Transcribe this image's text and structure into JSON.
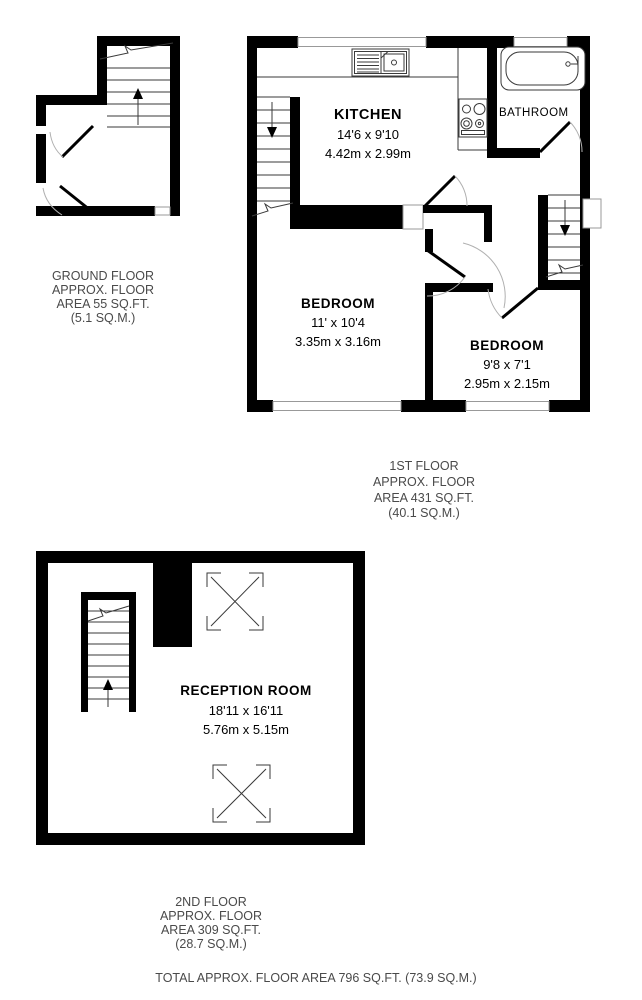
{
  "colors": {
    "wall": "#000000",
    "thin_line": "#3a3a3a",
    "arc": "#b0b0b0",
    "label_text": "#4a4a4a"
  },
  "floors": {
    "ground": {
      "label_lines": [
        "GROUND FLOOR",
        "APPROX. FLOOR",
        "AREA 55 SQ.FT.",
        "(5.1 SQ.M.)"
      ]
    },
    "first": {
      "label_lines": [
        "1ST FLOOR",
        "APPROX. FLOOR",
        "AREA 431 SQ.FT.",
        "(40.1 SQ.M.)"
      ],
      "rooms": {
        "kitchen": {
          "name": "KITCHEN",
          "dims_ft": "14'6 x 9'10",
          "dims_m": "4.42m x 2.99m"
        },
        "bathroom": {
          "name": "BATHROOM"
        },
        "bedroom1": {
          "name": "BEDROOM",
          "dims_ft": "11' x 10'4",
          "dims_m": "3.35m x 3.16m"
        },
        "bedroom2": {
          "name": "BEDROOM",
          "dims_ft": "9'8 x 7'1",
          "dims_m": "2.95m x 2.15m"
        }
      }
    },
    "second": {
      "label_lines": [
        "2ND FLOOR",
        "APPROX. FLOOR",
        "AREA 309 SQ.FT.",
        "(28.7 SQ.M.)"
      ],
      "rooms": {
        "reception": {
          "name": "RECEPTION ROOM",
          "dims_ft": "18'11 x 16'11",
          "dims_m": "5.76m x 5.15m"
        }
      }
    }
  },
  "total_line": "TOTAL APPROX. FLOOR AREA 796 SQ.FT. (73.9 SQ.M.)"
}
